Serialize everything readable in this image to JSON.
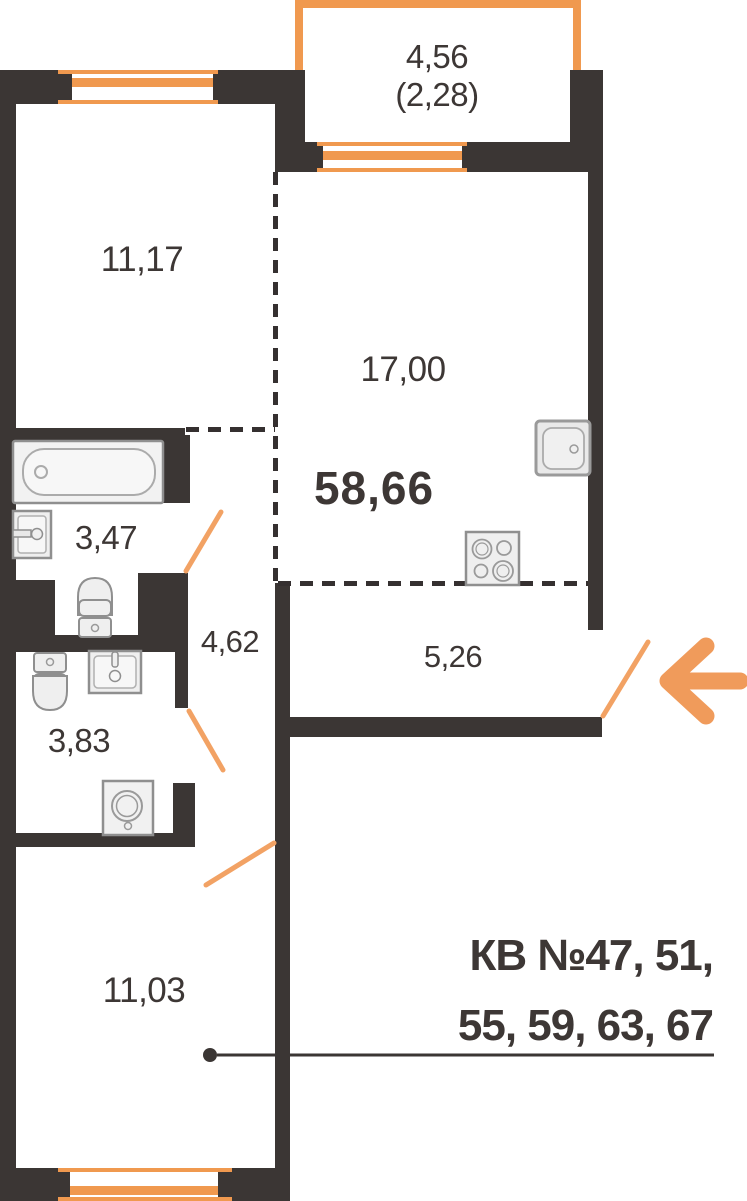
{
  "plan": {
    "areas": {
      "balcony_full": "4,56",
      "balcony_reduced": "(2,28)",
      "bedroom_top": "11,17",
      "kitchen_living": "17,00",
      "total": "58,66",
      "bathroom": "3,47",
      "corridor": "4,62",
      "hallway": "5,26",
      "wc": "3,83",
      "bedroom_bottom": "11,03"
    },
    "apartments_label": {
      "line1": "КВ №47, 51,",
      "line2": "55, 59, 63, 67"
    },
    "colors": {
      "wall": "#3B3634",
      "text": "#3D3735",
      "window_accent": "#F0994F",
      "door_accent": "#F2A264",
      "arrow": "#F09B5B",
      "fixture_fill": "#EFEFEF",
      "fixture_stroke": "#8F8F8F"
    },
    "icons": {
      "entrance_arrow": "left-arrow"
    }
  }
}
